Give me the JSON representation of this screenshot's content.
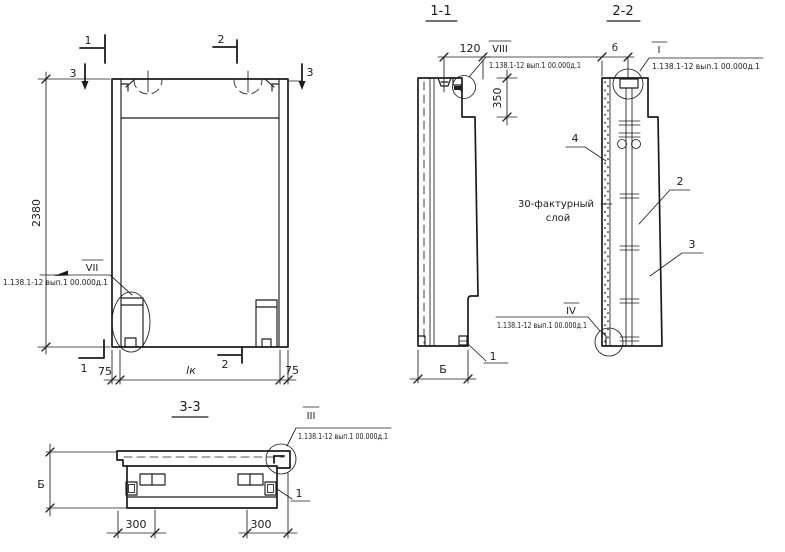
{
  "colors": {
    "ink": "#1c1c1c",
    "paper": "#ffffff"
  },
  "elevation": {
    "dim_height": "2380",
    "dims": {
      "left": "75",
      "mid": "lк",
      "right": "75"
    },
    "marks": {
      "top_1": "1",
      "top_2": "2",
      "left_3": "3",
      "right_3": "3",
      "bottom_1": "1",
      "bottom_2": "2"
    },
    "detail": {
      "label": "VII",
      "ref": "1.138.1-12 вып.1 00.000д.1"
    }
  },
  "s11": {
    "title": "1-1",
    "dims": {
      "offset": "120",
      "zone": "350",
      "width": "Б"
    },
    "detail": {
      "label": "VIII",
      "ref": "1.138.1-12 вып.1 00.000д.1"
    },
    "items": {
      "one": "1"
    }
  },
  "s22": {
    "title": "2-2",
    "dims": {
      "rib": "б"
    },
    "details": {
      "top": {
        "label": "I",
        "ref": "1.138.1-12 вып.1 00.000д.1"
      },
      "bottom": {
        "label": "IV",
        "ref": "1.138.1-12 вып.1 00.000д.1"
      }
    },
    "note": {
      "line1": "30-фактурный",
      "line2": "слой"
    },
    "items": {
      "n4": "4",
      "n2": "2",
      "n3": "3"
    }
  },
  "s33": {
    "title": "3-3",
    "dims": {
      "width": "Б",
      "left300": "300",
      "right300": "300"
    },
    "detail": {
      "label": "III",
      "ref": "1.138.1-12 вып.1 00.000д.1"
    },
    "items": {
      "one": "1"
    }
  }
}
